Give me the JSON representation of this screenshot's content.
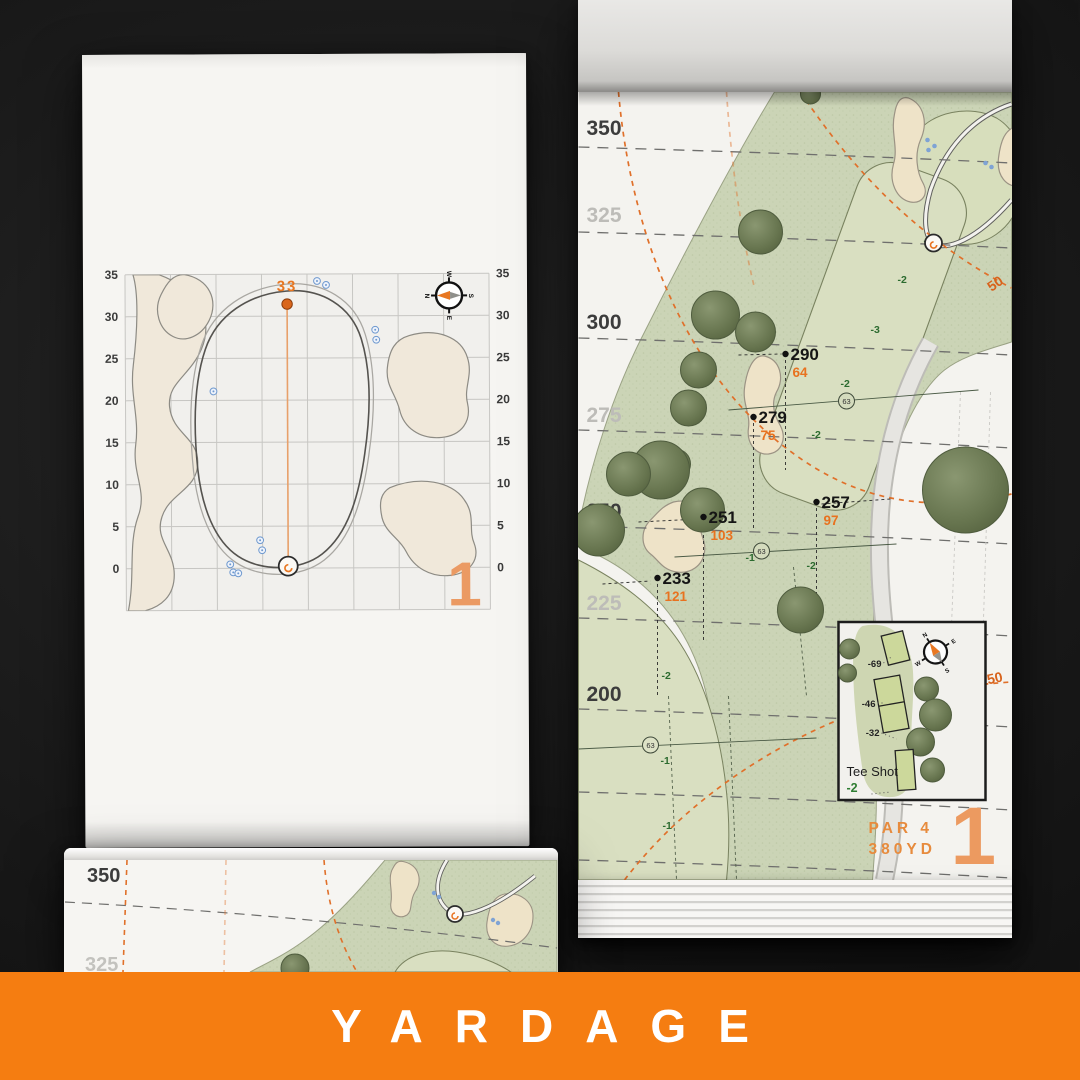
{
  "banner": {
    "title": "YARDAGE"
  },
  "hole": {
    "number": "1",
    "par_label": "PAR 4",
    "yardage_label": "380YD"
  },
  "compass": {
    "n": "N",
    "e": "E",
    "s": "S",
    "w": "W"
  },
  "left_chart": {
    "pin_depth": "33",
    "axis_values": [
      "35",
      "30",
      "25",
      "20",
      "15",
      "10",
      "5",
      "0"
    ]
  },
  "right_map": {
    "distance_labels": [
      {
        "v": "350",
        "major": true
      },
      {
        "v": "325",
        "major": false
      },
      {
        "v": "300",
        "major": true
      },
      {
        "v": "275",
        "major": false
      },
      {
        "v": "250",
        "major": true
      },
      {
        "v": "225",
        "major": false
      },
      {
        "v": "200",
        "major": true
      }
    ],
    "arc_labels": [
      "50",
      "100",
      "150"
    ],
    "points": [
      {
        "carry": "290",
        "remain": "64"
      },
      {
        "carry": "279",
        "remain": "75"
      },
      {
        "carry": "257",
        "remain": "97"
      },
      {
        "carry": "251",
        "remain": "103"
      },
      {
        "carry": "233",
        "remain": "121"
      }
    ],
    "sprinkler_id": "63",
    "elevations": [
      "-1",
      "-2",
      "-3",
      "-2",
      "-2",
      "-1",
      "-1",
      "-1",
      "-2",
      "-2"
    ],
    "tee_box": {
      "title": "Tee Shot",
      "elevation": "-2",
      "offsets": [
        "-69",
        "-46",
        "-32"
      ]
    }
  },
  "partial_page": {
    "labels": [
      "350",
      "325"
    ]
  },
  "colors": {
    "accent_orange": "#e87722",
    "banner_orange": "#f57d11",
    "elevation_green": "#2e7d32",
    "sprinkler_blue": "#7fa3d4",
    "sand": "#eee3c8",
    "rough_green": "#ccd5b8",
    "fairway_green": "#d8dfbf",
    "tree_green": "#6d7b55",
    "paper": "#f5f4f1"
  }
}
